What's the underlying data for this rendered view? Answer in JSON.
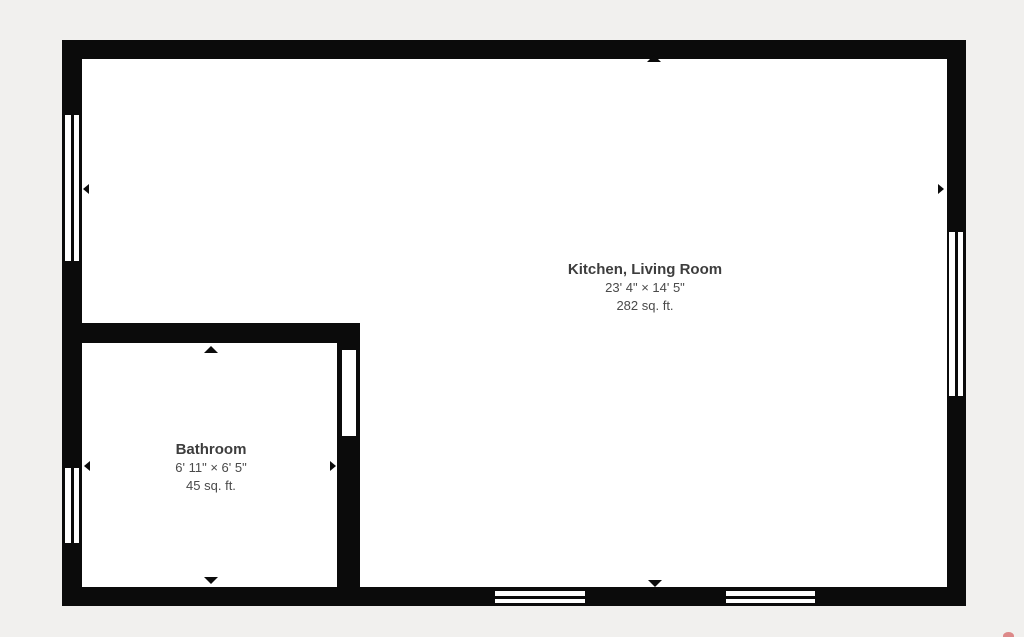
{
  "meta": {
    "type": "floor-plan"
  },
  "colors": {
    "background": "#f1f0ee",
    "wall": "#0b0b0b",
    "floor": "#ffffff",
    "room_name_text": "#3d3d3d",
    "dimension_text": "#4a4a4a",
    "watermark_red": "#d56767"
  },
  "rooms": [
    {
      "name": "Kitchen, Living Room",
      "dimensions": "23' 4\" × 14' 5\"",
      "area": "282 sq. ft."
    },
    {
      "name": "Bathroom",
      "dimensions": "6' 11\" × 6' 5\"",
      "area": "45 sq. ft."
    }
  ],
  "floorplan": {
    "interior": {
      "x": 82,
      "y": 58,
      "w": 865,
      "h": 530
    },
    "walls": [
      {
        "x": 62,
        "y": 40,
        "w": 904,
        "h": 19
      },
      {
        "x": 62,
        "y": 587,
        "w": 904,
        "h": 19
      },
      {
        "x": 62,
        "y": 40,
        "w": 20,
        "h": 566
      },
      {
        "x": 947,
        "y": 40,
        "w": 19,
        "h": 566
      },
      {
        "x": 62,
        "y": 323,
        "w": 298,
        "h": 20
      },
      {
        "x": 337,
        "y": 323,
        "w": 23,
        "h": 283
      }
    ],
    "windows": [
      {
        "x": 63,
        "y": 113,
        "w": 18,
        "h": 150,
        "o": "v"
      },
      {
        "x": 63,
        "y": 466,
        "w": 18,
        "h": 79,
        "o": "v"
      },
      {
        "x": 947,
        "y": 230,
        "w": 18,
        "h": 168,
        "o": "v"
      },
      {
        "x": 493,
        "y": 589,
        "w": 94,
        "h": 16,
        "o": "h"
      },
      {
        "x": 724,
        "y": 589,
        "w": 93,
        "h": 16,
        "o": "h"
      }
    ],
    "openings": [
      {
        "x": 340,
        "y": 350,
        "w": 18,
        "h": 86
      }
    ],
    "arrows": [
      {
        "dir": "up",
        "x": 647,
        "y": 55
      },
      {
        "dir": "left",
        "x": 83,
        "y": 184
      },
      {
        "dir": "right",
        "x": 938,
        "y": 184
      },
      {
        "dir": "up",
        "x": 204,
        "y": 346
      },
      {
        "dir": "left",
        "x": 84,
        "y": 461
      },
      {
        "dir": "right",
        "x": 330,
        "y": 461
      },
      {
        "dir": "down",
        "x": 204,
        "y": 577
      },
      {
        "dir": "down",
        "x": 648,
        "y": 580
      }
    ]
  },
  "watermark": {
    "x": 1003,
    "y": 632,
    "w": 11,
    "h": 8
  }
}
